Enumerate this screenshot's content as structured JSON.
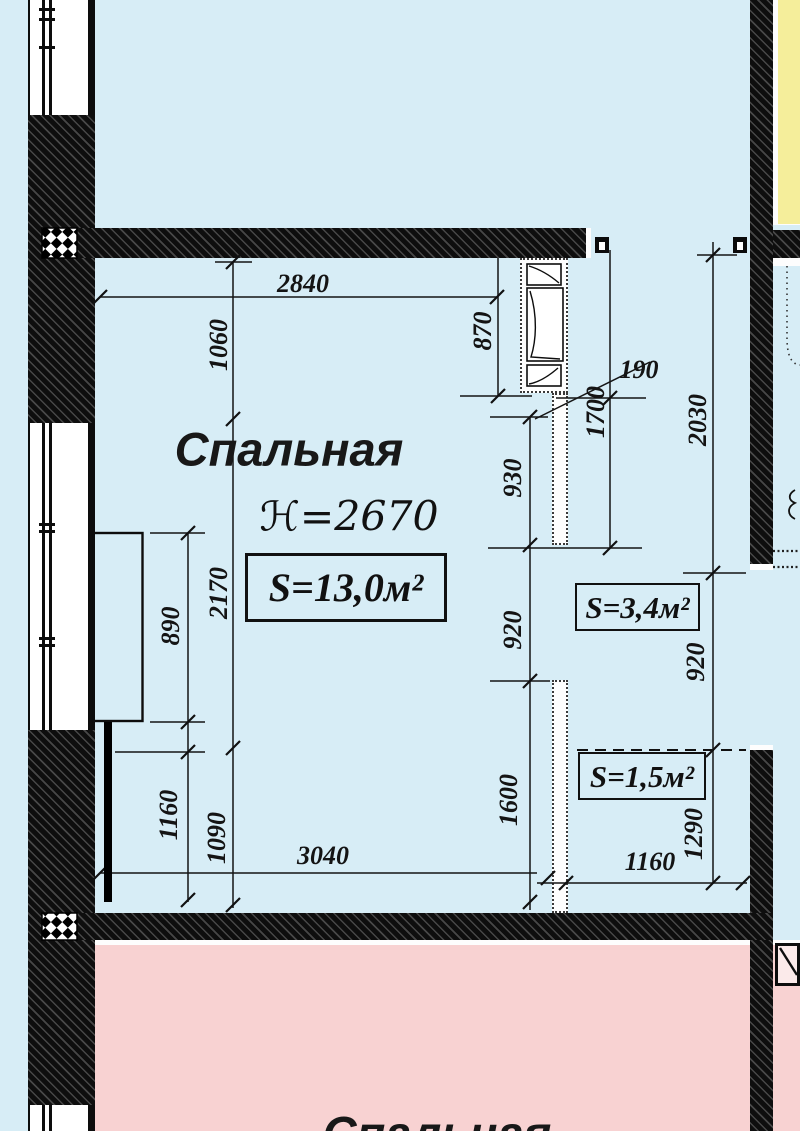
{
  "plan": {
    "room_main": {
      "name": "Спальная",
      "ceiling_height": "ℋ=2670",
      "area": "S=13,0м²"
    },
    "room_closet": {
      "area": "S=3,4м²"
    },
    "room_storage": {
      "area": "S=1,5м²"
    },
    "room_bottom": {
      "name": "Спальная"
    },
    "dims": {
      "w2840": "2840",
      "h1060": "1060",
      "h870": "870",
      "off190": "190",
      "h2030": "2030",
      "h1700": "1700",
      "h930": "930",
      "h920_mid": "920",
      "h920_right": "920",
      "h2170": "2170",
      "h890": "890",
      "h1160_left": "1160",
      "h1090": "1090",
      "h1600": "1600",
      "h1290": "1290",
      "w3040": "3040",
      "w1160_bottom": "1160"
    },
    "colors": {
      "room_blue": "#d7edf6",
      "room_pink": "#f8d2d2",
      "room_yellow": "#f5ee9b",
      "wall": "#0e0e0e"
    }
  }
}
